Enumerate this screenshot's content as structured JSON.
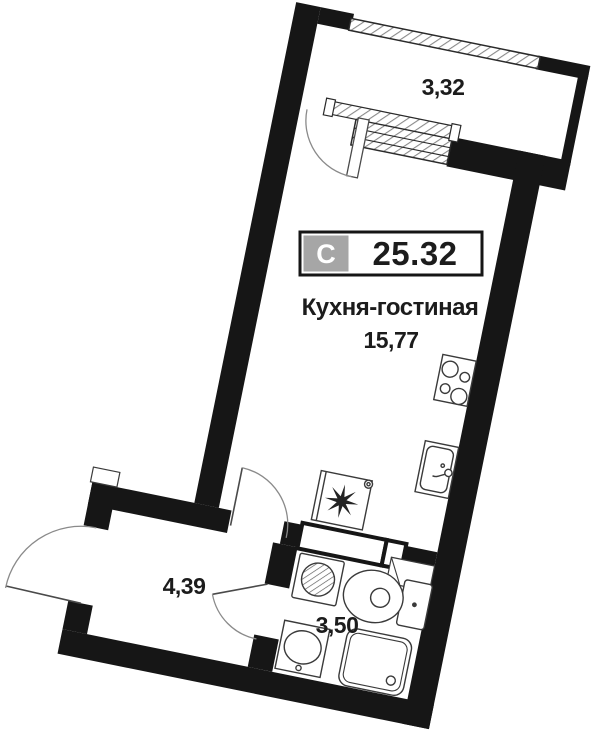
{
  "plan_labels": {
    "badge": {
      "type_letter": "С",
      "total_area": "25.32"
    },
    "kitchen_living": {
      "name": "Кухня-гостиная",
      "area": "15,77"
    },
    "balcony_area": "3,32",
    "hallway_area": "4,39",
    "bathroom_area": "3,50"
  },
  "colors": {
    "wall": "#161616",
    "badge_gray": "#a6a6a6",
    "background": "#ffffff",
    "fixture_line": "#3a3a3a",
    "arc_line": "#8a8a8a",
    "hatch_line": "#8a8a8a"
  },
  "fixtures": [
    "stove-icon",
    "kitchen-sink-icon",
    "fan-appliance-icon",
    "washing-machine-icon",
    "toilet-icon",
    "washbasin-icon",
    "shower-icon",
    "balcony-window",
    "entrance-door-arc",
    "interior-door-arcs"
  ]
}
